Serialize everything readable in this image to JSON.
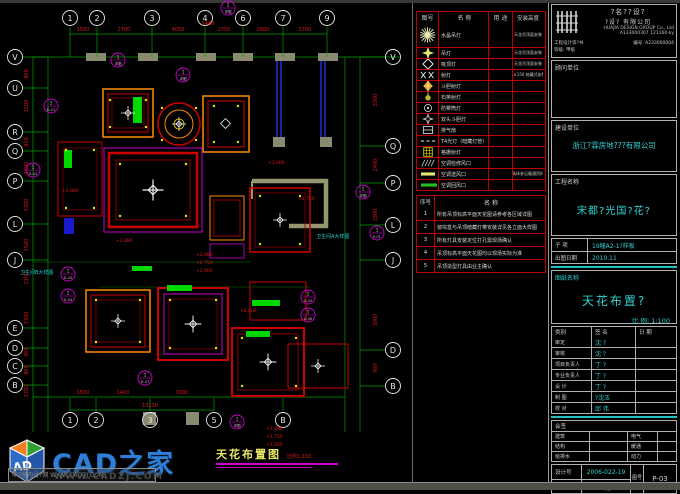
{
  "colors": {
    "bg": "#000000",
    "grid_green": "#00a000",
    "dim_red": "#d81818",
    "magenta": "#cc00cc",
    "cyan": "#30d0d0",
    "legend_border": "#bb0000",
    "wall_gray": "#8a8a70",
    "brand_blue": "#2e7fd9"
  },
  "drawing_title": {
    "text": "天花布置图",
    "note": "比例1:100"
  },
  "watermark": {
    "brand": "CAD之家",
    "url": "WWW.CADZJ.COM",
    "box_text": "中?室内设?网 WWW.CADZJ.COM",
    "cube_letters": "AD"
  },
  "legend": {
    "headers": [
      "图号",
      "名 称",
      "用 途",
      "安装高度"
    ],
    "rows": [
      {
        "symbol": "starburst",
        "name": "水晶吊灯",
        "usage": "",
        "height": "天花吊顶面安装"
      },
      {
        "symbol": "star4",
        "name": "吊灯",
        "usage": "",
        "height": "天花吊顶面安装"
      },
      {
        "symbol": "diamond-o",
        "name": "吸顶灯",
        "usage": "",
        "height": "天花吊顶面安装"
      },
      {
        "symbol": "xx",
        "name": "射灯",
        "usage": "",
        "height": "G×150 暗藏式安装"
      },
      {
        "symbol": "diamond-f",
        "name": "斗胆射灯",
        "usage": "",
        "height": ""
      },
      {
        "symbol": "lamp-s",
        "name": "石英射灯",
        "usage": "",
        "height": ""
      },
      {
        "symbol": "circle-dot",
        "name": "防雾筒灯",
        "usage": "",
        "height": ""
      },
      {
        "symbol": "star4-s",
        "name": "双头斗胆灯",
        "usage": "",
        "height": ""
      },
      {
        "symbol": "vent",
        "name": "排气扇",
        "usage": "",
        "height": ""
      },
      {
        "symbol": "dash",
        "name": "T4光灯（暗藏灯管）",
        "usage": "",
        "height": ""
      },
      {
        "symbol": "grid",
        "name": "格栅射灯",
        "usage": "",
        "height": ""
      },
      {
        "symbol": "hatch",
        "name": "空调检修风口",
        "usage": "",
        "height": ""
      },
      {
        "symbol": "supply",
        "name": "空调送风口",
        "usage": "",
        "height": "具体参见暖通资料"
      },
      {
        "symbol": "return",
        "name": "空调回风口",
        "usage": "",
        "height": ""
      }
    ]
  },
  "notes": {
    "headers": [
      "序号",
      "名  称"
    ],
    "rows": [
      {
        "no": "1",
        "text": "所有吊顶标高平面天花图请参考各区域详图"
      },
      {
        "no": "2",
        "text": "窗帘盒与吊顶暗藏灯带安装详见各立面大样图"
      },
      {
        "no": "3",
        "text": "所有灯具安装定位打孔需现场确认"
      },
      {
        "no": "4",
        "text": "吊顶标高平面天花图均以现场实际为准"
      },
      {
        "no": "5",
        "text": "吊顶造型灯具由业主确认"
      }
    ]
  },
  "titleblock": {
    "company_cn1": "?名??设?",
    "company_cn2": "?设? 有限公司",
    "company_en": "HUAJIA DESIGN GROUP Co., Ltd",
    "cert_no_top": "A133000307 121160-ky",
    "cert_label": "工程设计资?书",
    "cert_grade": "等级: 甲级",
    "cert_no": "编号: A233000004",
    "consultant_label": "顾问单位",
    "client_label": "建设单位",
    "client": "浙江?霖房地???有限公司",
    "project_label": "工程名称",
    "project": "宋都?光国?花?",
    "subitem_label": "子 项",
    "subitem": "19幢A2-1?样板",
    "date_label": "出图日期",
    "date": "2010.11",
    "sheetname_label": "图纸名称",
    "sheetname": "天花布置?",
    "scale": "比 例: 1:100",
    "sign_headers": [
      "类别",
      "签  名",
      "日 期"
    ],
    "sign_rows": [
      [
        "审定",
        "沈 ?"
      ],
      [
        "审核",
        "沈 ?"
      ],
      [
        "项目负责人",
        "丁 ?"
      ],
      [
        "专业负责人",
        "丁 ?"
      ],
      [
        "设 计",
        "丁 ?"
      ],
      [
        "制 图",
        "?沈玉"
      ],
      [
        "校 对",
        "邱 伟"
      ]
    ],
    "huiqian_label": "会签",
    "huiqian_rows": [
      [
        "建筑",
        "电气"
      ],
      [
        "结构",
        "暖通"
      ],
      [
        "给排水",
        "动力"
      ]
    ],
    "design_no_label": "设计号",
    "design_no": "2006-022-19",
    "sheet_no_label": "图号",
    "sheet_no": "P-03",
    "type_label": "图 别",
    "type": "?施"
  },
  "plan": {
    "grid_top": [
      {
        "l": "1",
        "x": 70
      },
      {
        "l": "2",
        "x": 97
      },
      {
        "l": "3",
        "x": 152
      },
      {
        "l": "4",
        "x": 205
      },
      {
        "l": "6",
        "x": 243
      },
      {
        "l": "7",
        "x": 283
      },
      {
        "l": "9",
        "x": 327
      }
    ],
    "grid_bottom": [
      {
        "l": "1",
        "x": 70
      },
      {
        "l": "2",
        "x": 96
      },
      {
        "l": "3",
        "x": 150
      },
      {
        "l": "5",
        "x": 214
      },
      {
        "l": "B",
        "x": 283
      }
    ],
    "grid_left": [
      {
        "l": "V",
        "y": 57
      },
      {
        "l": "U",
        "y": 88
      },
      {
        "l": "R",
        "y": 132
      },
      {
        "l": "Q",
        "y": 151
      },
      {
        "l": "P",
        "y": 181
      },
      {
        "l": "L",
        "y": 224
      },
      {
        "l": "J",
        "y": 260
      },
      {
        "l": "E",
        "y": 328
      },
      {
        "l": "D",
        "y": 348
      },
      {
        "l": "C",
        "y": 366
      },
      {
        "l": "B",
        "y": 385
      }
    ],
    "grid_right": [
      {
        "l": "V",
        "y": 57
      },
      {
        "l": "Q",
        "y": 146
      },
      {
        "l": "P",
        "y": 183
      },
      {
        "l": "L",
        "y": 225
      },
      {
        "l": "J",
        "y": 260
      },
      {
        "l": "D",
        "y": 350
      },
      {
        "l": "B",
        "y": 386
      }
    ],
    "dims_top": [
      {
        "t": "1500",
        "x": 83
      },
      {
        "t": "2700",
        "x": 124
      },
      {
        "t": "4050",
        "x": 178
      },
      {
        "t": "2750",
        "x": 224
      },
      {
        "t": "2600",
        "x": 263
      },
      {
        "t": "2700",
        "x": 305
      }
    ],
    "dim_extra": {
      "t": "1488",
      "x": 208,
      "y": 25
    },
    "dims_bottom": [
      {
        "t": "1500",
        "x": 83
      },
      {
        "t": "1400",
        "x": 123
      },
      {
        "t": "3000",
        "x": 182
      }
    ],
    "dim_total": {
      "t": "13130",
      "x": 150,
      "y": 407
    },
    "dims_left": [
      {
        "t": "900",
        "y": 74
      },
      {
        "t": "1500",
        "y": 106
      },
      {
        "t": "900",
        "y": 142
      },
      {
        "t": "1800",
        "y": 168
      },
      {
        "t": "3300",
        "y": 205
      },
      {
        "t": "1500",
        "y": 245
      },
      {
        "t": "2100",
        "y": 278
      },
      {
        "t": "3300",
        "y": 318
      },
      {
        "t": "900",
        "y": 352
      },
      {
        "t": "900",
        "y": 370
      },
      {
        "t": "1350",
        "y": 391
      }
    ],
    "dims_right": [
      {
        "t": "3300",
        "y": 100
      },
      {
        "t": "2400",
        "y": 165
      },
      {
        "t": "1800",
        "y": 215
      },
      {
        "t": "3000",
        "y": 320
      },
      {
        "t": "900",
        "y": 368
      }
    ],
    "callouts": [
      {
        "x": 118,
        "y": 60,
        "c": "详图"
      },
      {
        "x": 183,
        "y": 75,
        "c": "详图"
      },
      {
        "x": 51,
        "y": 106,
        "c": "D-01"
      },
      {
        "x": 33,
        "y": 170,
        "c": "D-02"
      },
      {
        "x": 68,
        "y": 274,
        "c": "D-03"
      },
      {
        "x": 68,
        "y": 296,
        "c": "D-04"
      },
      {
        "x": 363,
        "y": 192,
        "c": "详图"
      },
      {
        "x": 377,
        "y": 233,
        "c": "K-01"
      },
      {
        "x": 308,
        "y": 297,
        "c": "D-05"
      },
      {
        "x": 308,
        "y": 315,
        "c": "D-06"
      },
      {
        "x": 145,
        "y": 378,
        "c": "D-07"
      },
      {
        "x": 237,
        "y": 422,
        "c": "详图"
      },
      {
        "x": 228,
        "y": 8,
        "c": "详图"
      }
    ],
    "elevations": [
      {
        "t": "+2.880",
        "x": 196,
        "y": 256
      },
      {
        "t": "+2.750",
        "x": 196,
        "y": 264
      },
      {
        "t": "+2.600",
        "x": 196,
        "y": 272
      },
      {
        "t": "+2.880",
        "x": 62,
        "y": 192
      },
      {
        "t": "+3.000",
        "x": 268,
        "y": 164
      },
      {
        "t": "+2.750",
        "x": 298,
        "y": 200
      },
      {
        "t": "+2.880",
        "x": 116,
        "y": 242
      },
      {
        "t": "+2.600",
        "x": 240,
        "y": 312
      },
      {
        "t": "+2.880",
        "x": 266,
        "y": 430
      },
      {
        "t": "+2.750",
        "x": 266,
        "y": 438
      },
      {
        "t": "+2.600",
        "x": 266,
        "y": 446
      }
    ],
    "labels": [
      {
        "t": "卫生间A大样图",
        "x": 316,
        "y": 238
      },
      {
        "t": "卫生间B大样图",
        "x": 20,
        "y": 274
      }
    ]
  }
}
